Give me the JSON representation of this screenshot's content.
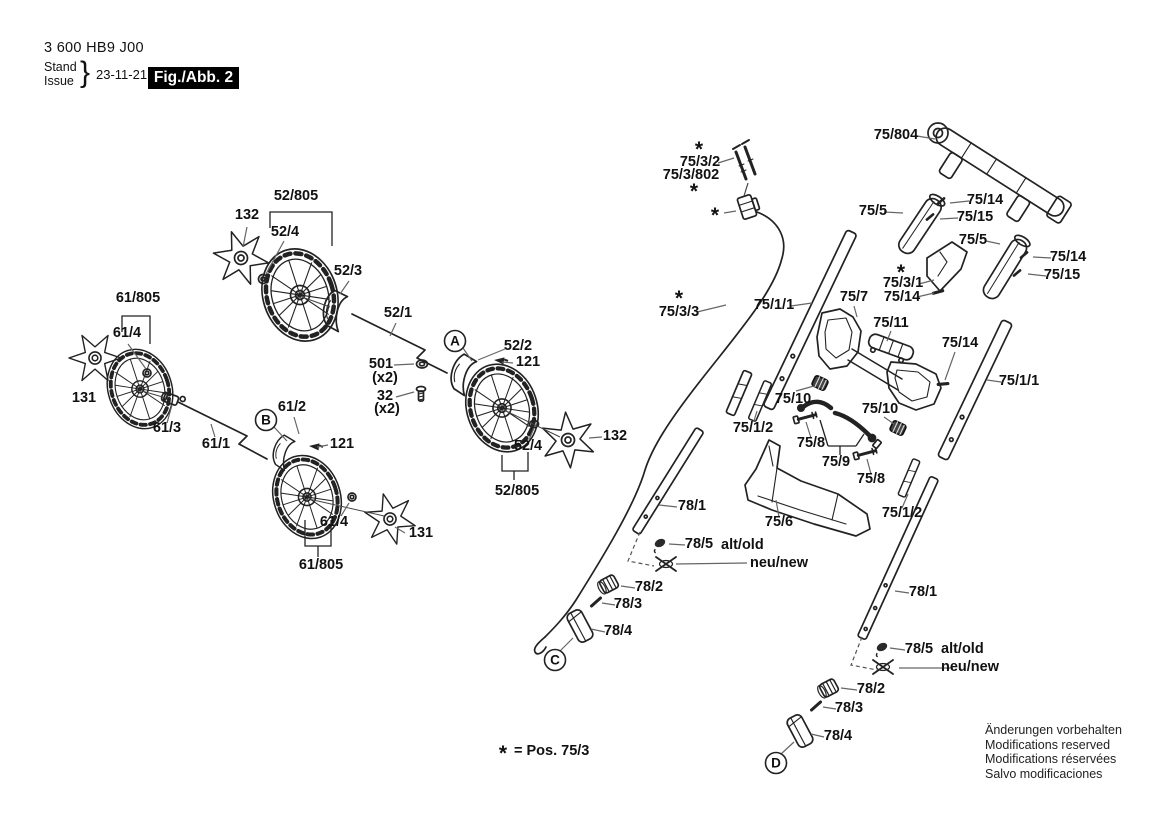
{
  "header": {
    "part_no": "3 600 HB9 J00",
    "stand": "Stand",
    "issue": "Issue",
    "brace": "}",
    "date": "23-11-21",
    "figure": "Fig./Abb. 2"
  },
  "disclaimer": {
    "line1": "Änderungen vorbehalten",
    "line2": "Modifications reserved",
    "line3": "Modifications réservées",
    "line4": "Salvo modificaciones"
  },
  "colors": {
    "ink": "#222222",
    "leader": "#666666",
    "figure_box_bg": "#000000",
    "figure_box_fg": "#ffffff"
  },
  "callouts": [
    {
      "t": "52/805",
      "x": 296,
      "y": 200
    },
    {
      "t": "132",
      "x": 247,
      "y": 219
    },
    {
      "t": "52/4",
      "x": 285,
      "y": 236
    },
    {
      "t": "52/3",
      "x": 348,
      "y": 275
    },
    {
      "t": "52/1",
      "x": 398,
      "y": 317
    },
    {
      "t": "A",
      "x": 455,
      "cy": 341,
      "circled": true
    },
    {
      "t": "52/2",
      "x": 518,
      "y": 350
    },
    {
      "t": "121",
      "x": 528,
      "y": 366
    },
    {
      "t": "501",
      "x": 381,
      "y": 368
    },
    {
      "t": "(x2)",
      "x": 385,
      "y": 382
    },
    {
      "t": "32",
      "x": 385,
      "y": 400
    },
    {
      "t": "(x2)",
      "x": 387,
      "y": 413
    },
    {
      "t": "61/805",
      "x": 138,
      "y": 302
    },
    {
      "t": "61/4",
      "x": 127,
      "y": 337
    },
    {
      "t": "131",
      "x": 84,
      "y": 402
    },
    {
      "t": "61/3",
      "x": 167,
      "y": 432
    },
    {
      "t": "61/1",
      "x": 216,
      "y": 448
    },
    {
      "t": "B",
      "x": 266,
      "cy": 420,
      "circled": true
    },
    {
      "t": "61/2",
      "x": 292,
      "y": 411
    },
    {
      "t": "121",
      "x": 342,
      "y": 448
    },
    {
      "t": "61/4",
      "x": 334,
      "y": 526
    },
    {
      "t": "131",
      "x": 421,
      "y": 537
    },
    {
      "t": "61/805",
      "x": 321,
      "y": 569
    },
    {
      "t": "52/4",
      "x": 528,
      "y": 450
    },
    {
      "t": "132",
      "x": 615,
      "y": 440
    },
    {
      "t": "52/805",
      "x": 517,
      "y": 495
    },
    {
      "t": "*",
      "x": 699,
      "y": 156,
      "star": true
    },
    {
      "t": "75/3/2",
      "x": 700,
      "y": 166
    },
    {
      "t": "75/3/802",
      "x": 691,
      "y": 179
    },
    {
      "t": "*",
      "x": 694,
      "y": 198,
      "star": true
    },
    {
      "t": "*",
      "x": 715,
      "y": 222,
      "star": true
    },
    {
      "t": "75/804",
      "x": 896,
      "y": 139
    },
    {
      "t": "75/5",
      "x": 873,
      "y": 215
    },
    {
      "t": "75/14",
      "x": 985,
      "y": 204
    },
    {
      "t": "75/15",
      "x": 975,
      "y": 221
    },
    {
      "t": "75/5",
      "x": 973,
      "y": 244
    },
    {
      "t": "75/14",
      "x": 1068,
      "y": 261
    },
    {
      "t": "75/15",
      "x": 1062,
      "y": 279
    },
    {
      "t": "*",
      "x": 901,
      "y": 279,
      "star": true
    },
    {
      "t": "75/3/1",
      "x": 903,
      "y": 287
    },
    {
      "t": "75/14",
      "x": 902,
      "y": 301
    },
    {
      "t": "*",
      "x": 679,
      "y": 305,
      "star": true
    },
    {
      "t": "75/3/3",
      "x": 679,
      "y": 316
    },
    {
      "t": "75/1/1",
      "x": 774,
      "y": 309
    },
    {
      "t": "75/7",
      "x": 854,
      "y": 301
    },
    {
      "t": "75/11",
      "x": 891,
      "y": 327
    },
    {
      "t": "75/14",
      "x": 960,
      "y": 347
    },
    {
      "t": "75/1/1",
      "x": 1019,
      "y": 385
    },
    {
      "t": "75/10",
      "x": 793,
      "y": 403
    },
    {
      "t": "75/1/2",
      "x": 753,
      "y": 432
    },
    {
      "t": "75/8",
      "x": 811,
      "y": 447
    },
    {
      "t": "75/9",
      "x": 836,
      "y": 466
    },
    {
      "t": "75/10",
      "x": 880,
      "y": 413
    },
    {
      "t": "75/8",
      "x": 871,
      "y": 483
    },
    {
      "t": "75/6",
      "x": 779,
      "y": 526
    },
    {
      "t": "75/1/2",
      "x": 902,
      "y": 517
    },
    {
      "t": "78/1",
      "x": 692,
      "y": 510
    },
    {
      "t": "78/5",
      "x": 699,
      "y": 548
    },
    {
      "t": "alt/old",
      "x": 721,
      "y": 549,
      "a": "start"
    },
    {
      "t": "neu/new",
      "x": 750,
      "y": 567,
      "a": "start"
    },
    {
      "t": "78/2",
      "x": 649,
      "y": 591
    },
    {
      "t": "78/3",
      "x": 628,
      "y": 608
    },
    {
      "t": "78/4",
      "x": 618,
      "y": 635
    },
    {
      "t": "C",
      "x": 555,
      "cy": 660,
      "circled": true
    },
    {
      "t": "78/1",
      "x": 923,
      "y": 596
    },
    {
      "t": "78/5",
      "x": 919,
      "y": 653
    },
    {
      "t": "alt/old",
      "x": 941,
      "y": 653,
      "a": "start"
    },
    {
      "t": "neu/new",
      "x": 941,
      "y": 671,
      "a": "start"
    },
    {
      "t": "78/2",
      "x": 871,
      "y": 693
    },
    {
      "t": "78/3",
      "x": 849,
      "y": 712
    },
    {
      "t": "78/4",
      "x": 838,
      "y": 740
    },
    {
      "t": "D",
      "x": 776,
      "cy": 763,
      "circled": true
    },
    {
      "t": "*",
      "x": 503,
      "y": 760,
      "star": true
    },
    {
      "t": "= Pos. 75/3",
      "x": 514,
      "y": 755,
      "a": "start"
    }
  ]
}
